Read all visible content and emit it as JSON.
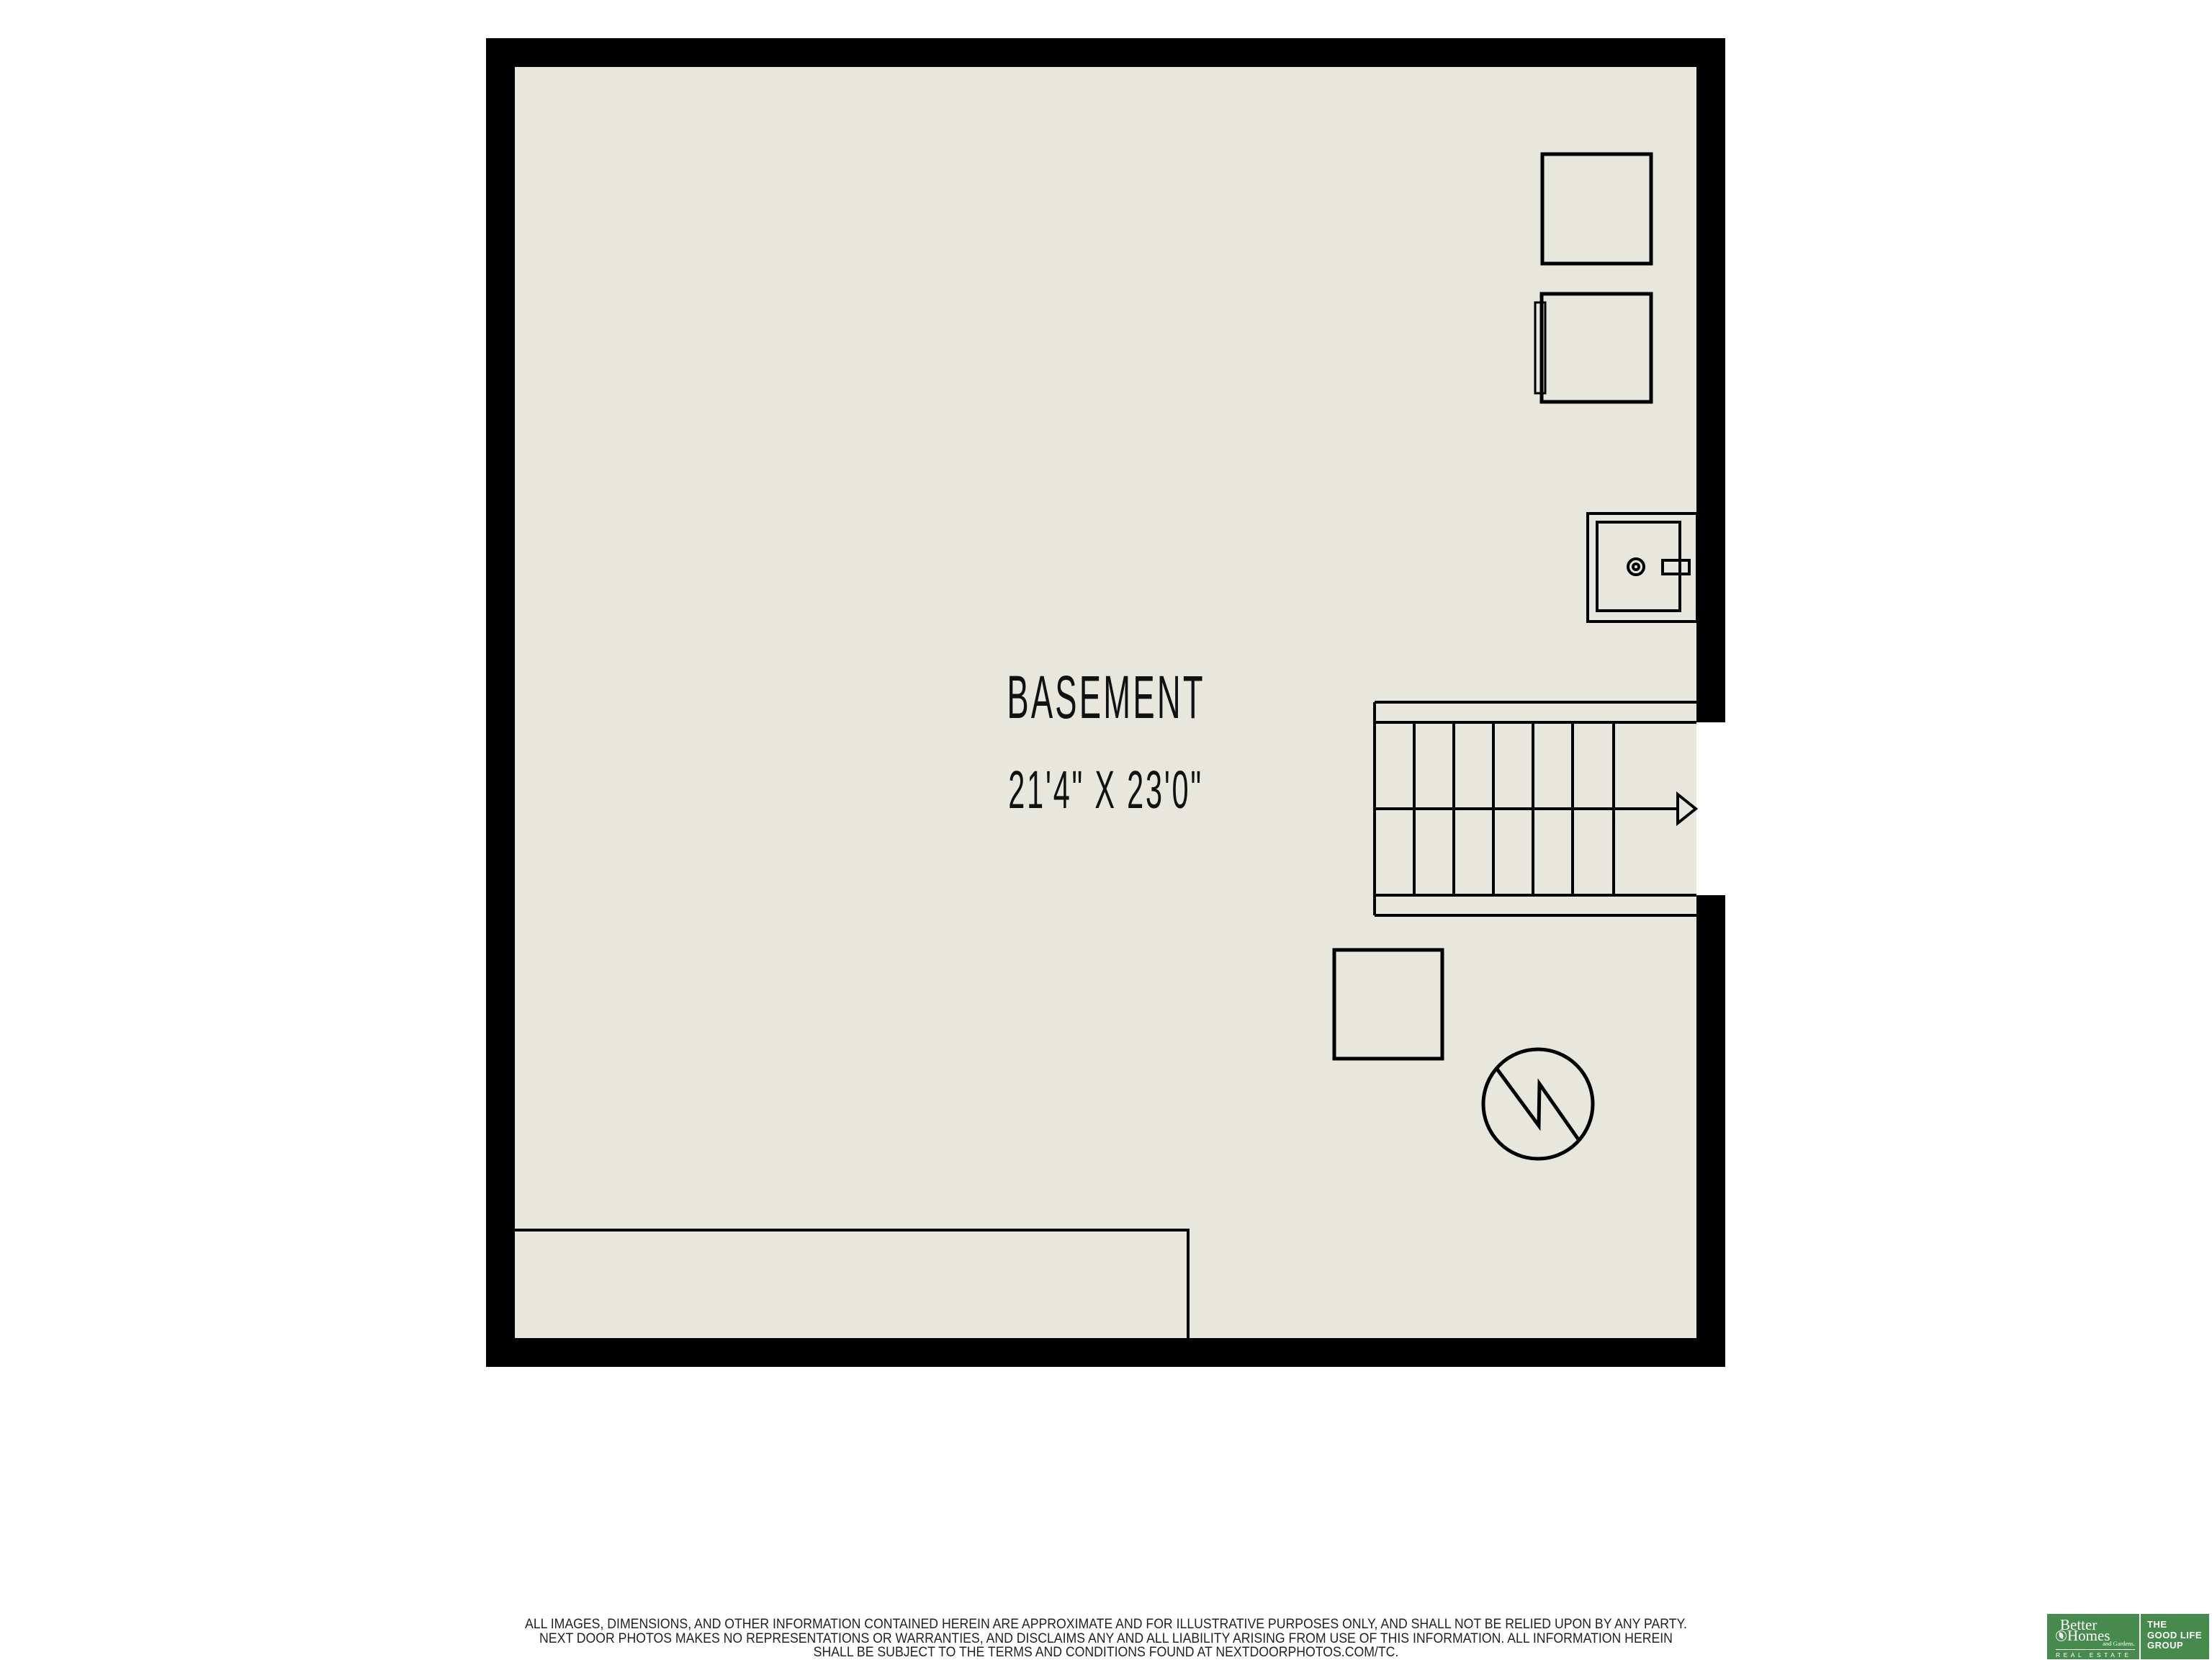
{
  "room": {
    "name": "BASEMENT",
    "size": "21'4\" X 23'0\""
  },
  "disclaimer": {
    "line1": "ALL IMAGES, DIMENSIONS, AND OTHER INFORMATION CONTAINED HEREIN ARE APPROXIMATE AND FOR ILLUSTRATIVE PURPOSES ONLY, AND SHALL NOT BE RELIED UPON BY ANY PARTY.",
    "line2": "NEXT DOOR PHOTOS MAKES NO REPRESENTATIONS OR WARRANTIES, AND DISCLAIMS ANY AND ALL LIABILITY ARISING FROM USE OF THIS INFORMATION. ALL INFORMATION HEREIN",
    "line3": "SHALL BE SUBJECT TO THE TERMS AND CONDITIONS FOUND AT NEXTDOORPHOTOS.COM/TC."
  },
  "logo": {
    "brand_word1": "Better",
    "brand_word2": "Homes",
    "brand_word3": "and Gardens.",
    "brand_tagline": "REAL ESTATE",
    "group_line1": "THE",
    "group_line2": "GOOD LIFE",
    "group_line3": "GROUP"
  },
  "icons": {
    "furnace": "furnace-icon",
    "water_heater": "water-heater-icon",
    "utility_sink": "utility-sink-icon",
    "equipment_box": "equipment-box-icon",
    "sump_pump": "sump-pump-icon",
    "stairs_arrow": "stairs-direction-arrow-icon",
    "leaf": "leaf-icon"
  },
  "colors": {
    "floor": "#e8e7de",
    "line": "#000000",
    "logo_green": "#478a4d",
    "disclaimer_text": "#222222"
  }
}
